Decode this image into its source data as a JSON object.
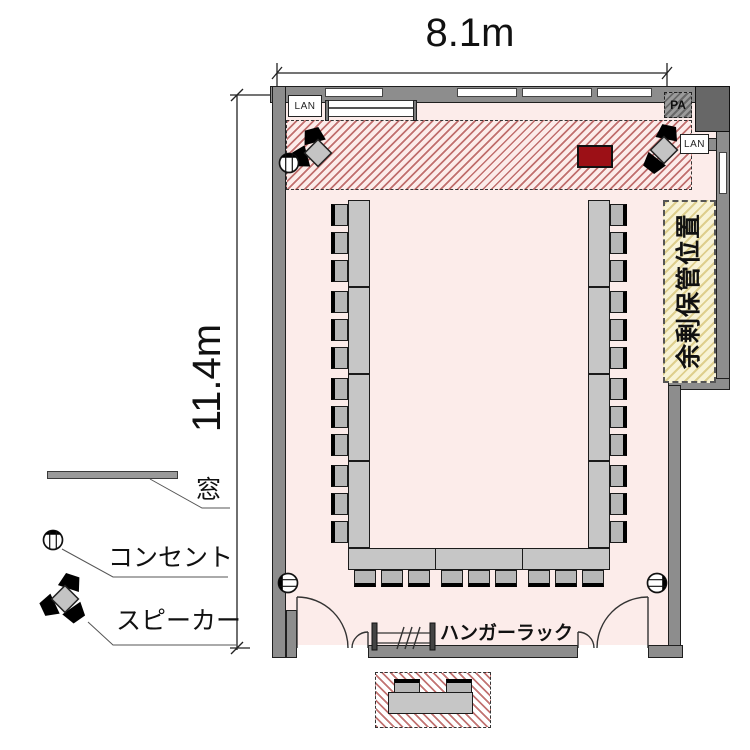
{
  "dimensions": {
    "width": "8.1m",
    "depth": "11.4m"
  },
  "legend": {
    "window_label": "窓",
    "outlet_label": "コンセント",
    "speaker_label": "スピーカー"
  },
  "labels": {
    "hanger_rack": "ハンガーラック",
    "surplus_storage": "余剰保管位置",
    "pa": "PA",
    "lan_left": "LAN",
    "lan_right": "LAN"
  },
  "furniture": {
    "u_shape_tables": {
      "left_sections": 4,
      "right_sections": 4,
      "bottom_sections": 3,
      "chairs_left": 12,
      "chairs_right": 12,
      "chairs_bottom": 9
    },
    "reception_table_chairs": 2
  },
  "colors": {
    "floor": "#fcecea",
    "wall": "#8d8d8d",
    "wall-dark": "#676767",
    "red-stripe": "#b2504e",
    "storage": "#f8f3d6",
    "table": "#c6c6c6",
    "projector": "#9c1016"
  }
}
